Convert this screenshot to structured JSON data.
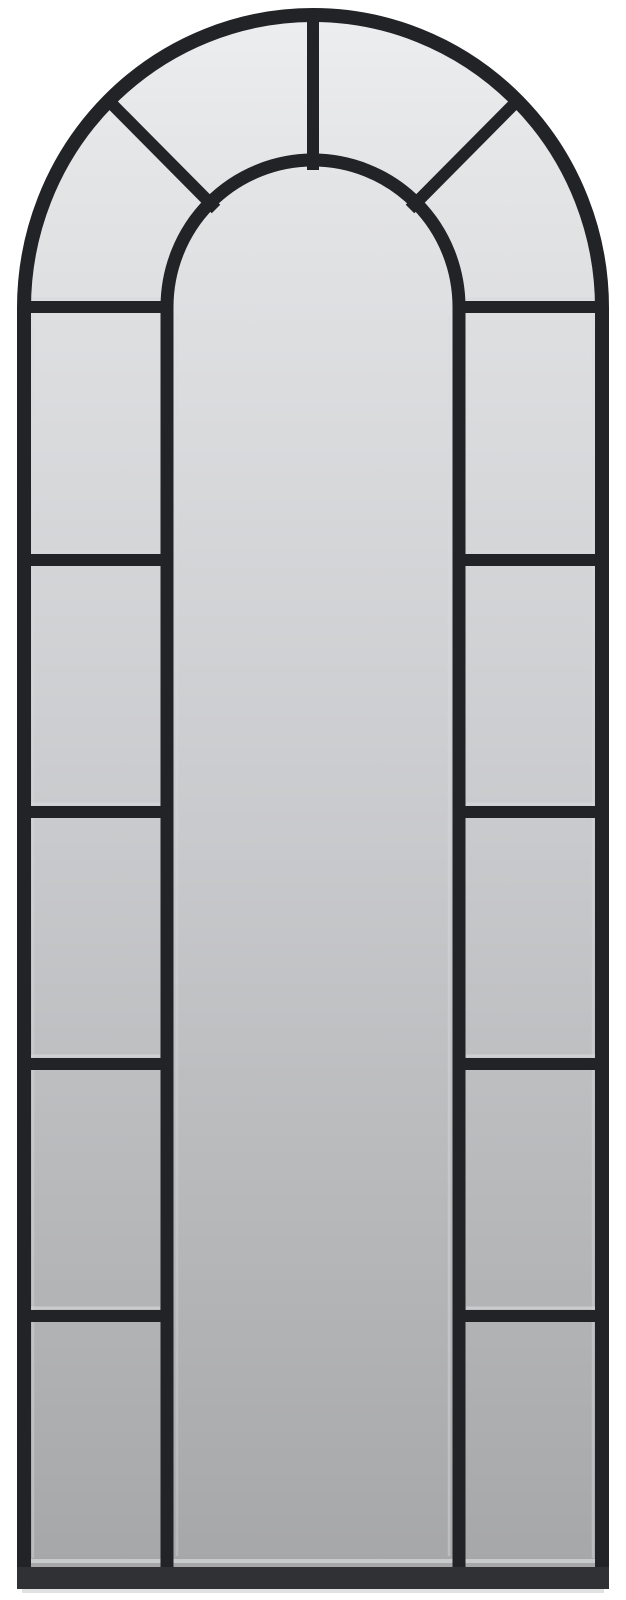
{
  "page": {
    "background": "#ffffff"
  },
  "product": {
    "name": "arched-window-pane-mirror",
    "frame_color": "#222327",
    "frame_bottom_color": "#2f3134",
    "glass": {
      "top_color": "#edeeef",
      "upper_color": "#e4e5e7",
      "mid_color": "#c9cacd",
      "bottom_color": "#a5a6a7"
    },
    "highlight_color": "#d6dadb",
    "shadow_color": "#c6c8ca",
    "structure": {
      "fan_panes": 4,
      "side_columns": 2,
      "side_panes_per_column": 5,
      "center_panels": 1
    }
  }
}
